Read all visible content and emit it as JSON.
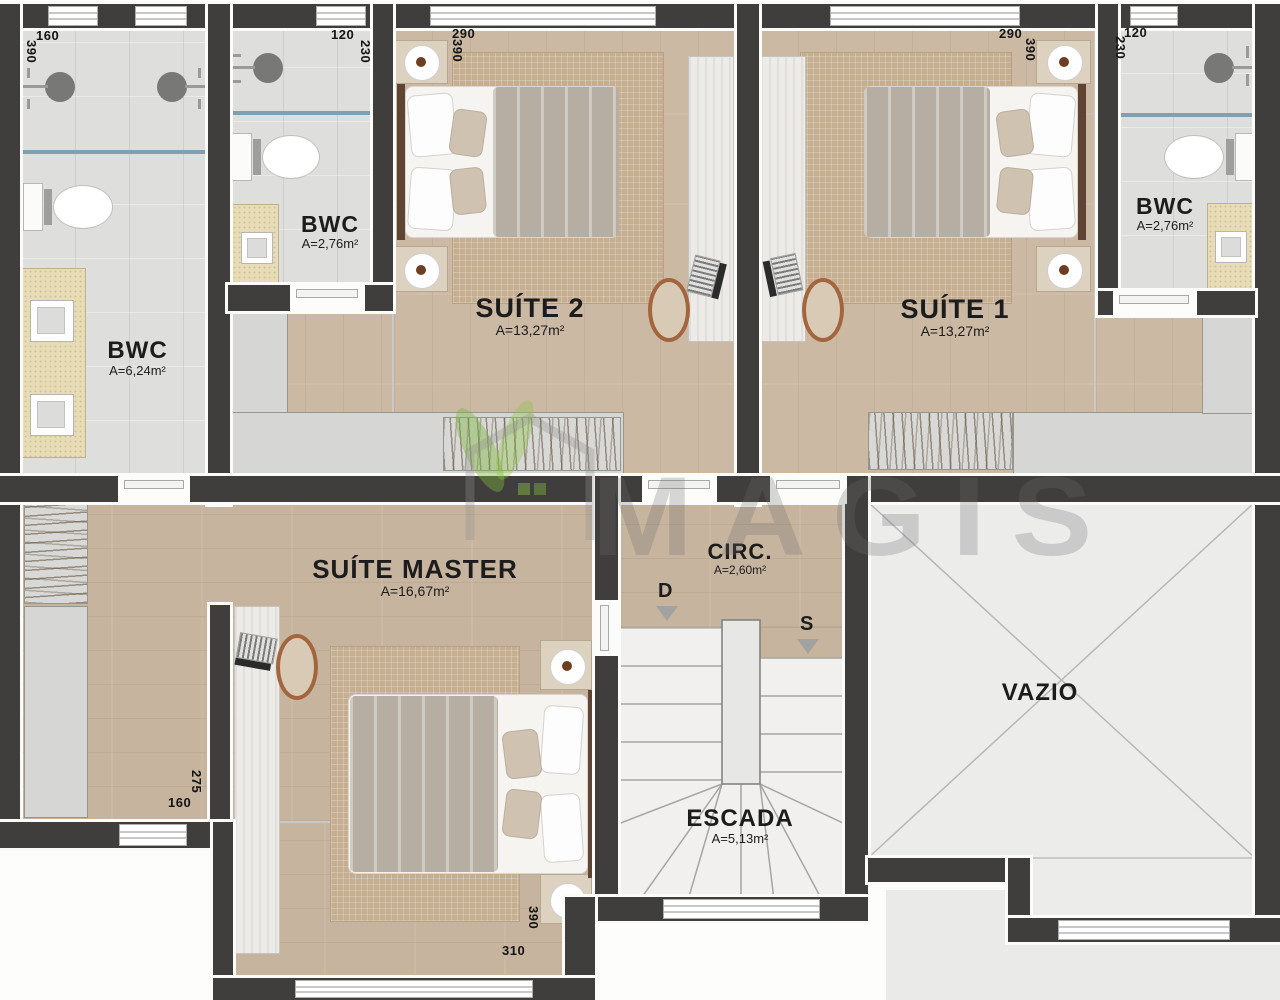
{
  "watermark": {
    "brand": "MAGIS"
  },
  "rooms": {
    "bwc_main": {
      "name": "BWC",
      "area": "A=6,24m²"
    },
    "bwc_suite2": {
      "name": "BWC",
      "area": "A=2,76m²"
    },
    "suite2": {
      "name": "SUÍTE 2",
      "area": "A=13,27m²"
    },
    "suite1": {
      "name": "SUÍTE 1",
      "area": "A=13,27m²"
    },
    "bwc_suite1": {
      "name": "BWC",
      "area": "A=2,76m²"
    },
    "suite_master": {
      "name": "SUÍTE MASTER",
      "area": "A=16,67m²"
    },
    "circulation": {
      "name": "CIRC.",
      "area": "A=2,60m²"
    },
    "stairs": {
      "name": "ESCADA",
      "area": "A=5,13m²"
    },
    "void": {
      "name": "VAZIO"
    }
  },
  "stair_arrows": {
    "down": "D",
    "up": "S"
  },
  "dimensions": {
    "bwc_main_w": "160",
    "bwc_main_h": "390",
    "bwc_suite2_w": "120",
    "bwc_suite2_h": "230",
    "suite2_w": "290",
    "suite2_h": "390",
    "suite1_w": "290",
    "suite1_h": "390",
    "bwc_suite1_w": "120",
    "bwc_suite1_h": "230",
    "master_nook_w": "160",
    "master_nook_h": "275",
    "master_w": "310",
    "master_h": "390"
  },
  "colors": {
    "wall": "#403e3d",
    "wood_floor": "#cbb9a3",
    "tile_floor": "#dededc",
    "counter_sand": "#e7dcb6",
    "glass_divider": "#7fa0b2",
    "watermark_green": "#7cb53e",
    "watermark_gray": "#6d6d6d"
  }
}
